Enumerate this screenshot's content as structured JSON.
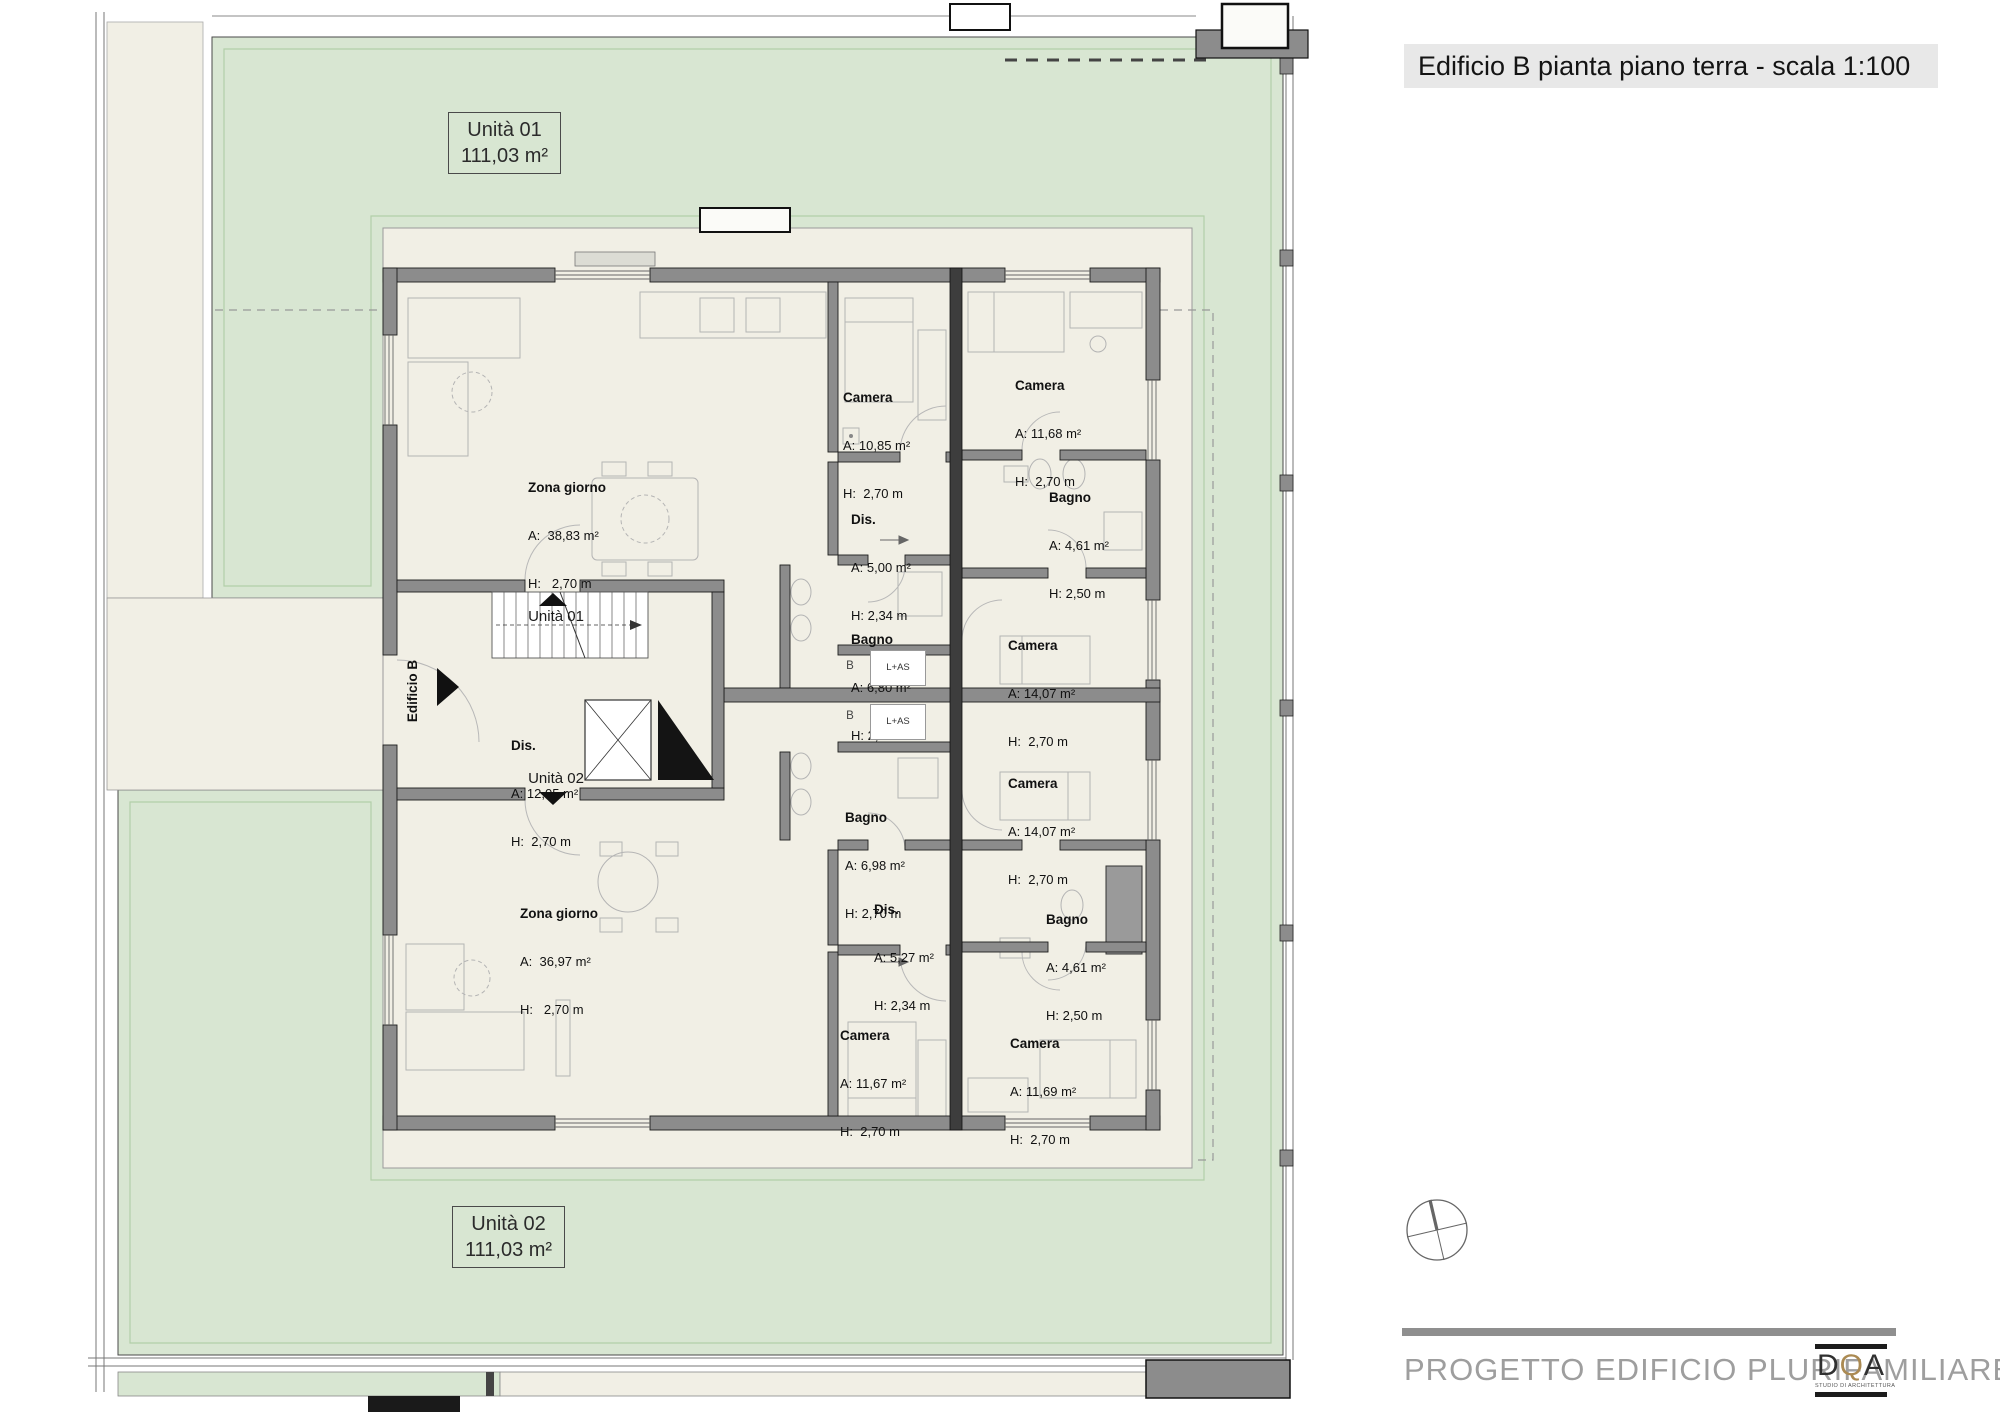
{
  "title": "Edificio B pianta piano terra - scala 1:100",
  "units": {
    "unit1": {
      "name": "Unità 01",
      "area": "111,03 m²"
    },
    "unit2": {
      "name": "Unità 02",
      "area": "111,03 m²"
    }
  },
  "rooms": [
    {
      "name": "Zona giorno",
      "area": "A:  38,83 m²",
      "height": "H:   2,70 m"
    },
    {
      "name": "Camera",
      "area": "A: 10,85 m²",
      "height": "H:  2,70 m"
    },
    {
      "name": "Camera",
      "area": "A: 11,68 m²",
      "height": "H:  2,70 m"
    },
    {
      "name": "Dis.",
      "area": "A: 5,00 m²",
      "height": "H: 2,34 m"
    },
    {
      "name": "Bagno",
      "area": "A: 4,61 m²",
      "height": "H: 2,50 m"
    },
    {
      "name": "Bagno",
      "area": "A: 6,80 m²",
      "height": "H: 2,70 m"
    },
    {
      "name": "Camera",
      "area": "A: 14,07 m²",
      "height": "H:  2,70 m"
    },
    {
      "name": "Dis.",
      "area": "A: 12,05 m²",
      "height": "H:  2,70 m"
    },
    {
      "name": "Bagno",
      "area": "A: 6,98 m²",
      "height": "H: 2,70 m"
    },
    {
      "name": "Camera",
      "area": "A: 14,07 m²",
      "height": "H:  2,70 m"
    },
    {
      "name": "Dis.",
      "area": "A: 5,27 m²",
      "height": "H: 2,34 m"
    },
    {
      "name": "Bagno",
      "area": "A: 4,61 m²",
      "height": "H: 2,50 m"
    },
    {
      "name": "Zona giorno",
      "area": "A:  36,97 m²",
      "height": "H:   2,70 m"
    },
    {
      "name": "Camera",
      "area": "A: 11,67 m²",
      "height": "H:  2,70 m"
    },
    {
      "name": "Camera",
      "area": "A: 11,69 m²",
      "height": "H:  2,70 m"
    }
  ],
  "core": {
    "unit1_entry": "Unità 01",
    "unit2_entry": "Unità 02",
    "building": "Edificio B"
  },
  "appliances": {
    "b1": "B",
    "las1": "L+AS",
    "b2": "B",
    "las2": "L+AS"
  },
  "footer": {
    "project": "PROGETTO EDIFICIO PLURIFAMILIARE",
    "logo_d": "D",
    "logo_q": "Q",
    "logo_a": "A",
    "logo_sub": "STUDIO DI ARCHITETTURA"
  },
  "colors": {
    "garden_green": "#d8e6d2",
    "patio_beige": "#f1efe5",
    "wall_gray": "#8c8c8c",
    "logo_gold": "#ab8a52"
  }
}
